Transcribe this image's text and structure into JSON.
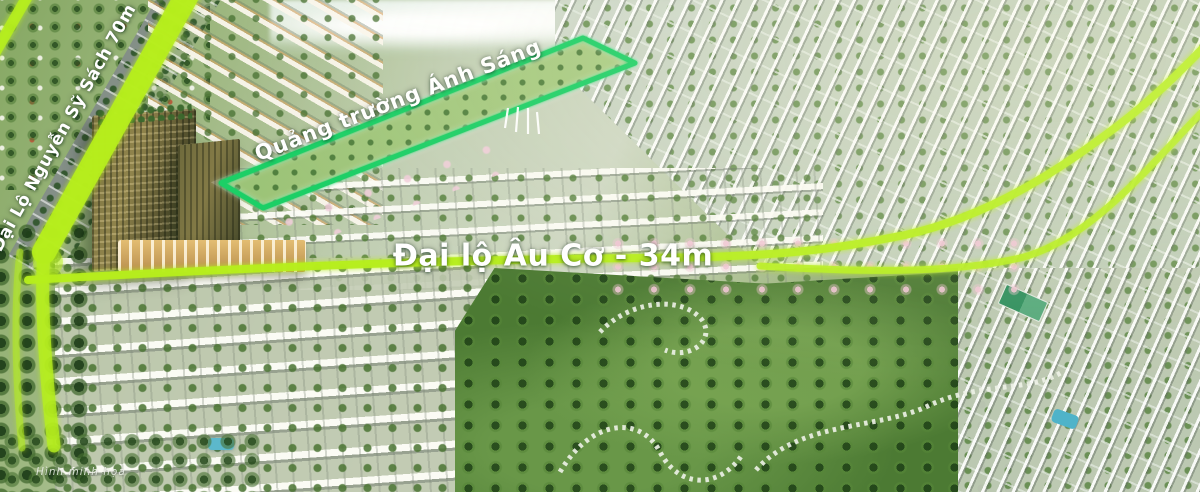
{
  "scene": {
    "description": "Aerial 3D masterplan render of an eco-urban township with highlighted avenues and central light square"
  },
  "colors": {
    "highway_highlight": "#b6ee1e",
    "plaza_outline": "#1dcf66",
    "label_text": "#ffffff",
    "watermark_text": "#eef3ea",
    "park_path": "#eef2e8",
    "fountain_white": "#ffffff"
  },
  "labels": {
    "road_diagonal": "Đại Lộ Nguyễn Sỹ Sách 70m",
    "plaza": "Quảng trường Ánh Sáng",
    "road_main": "Đại lộ Âu Cơ - 34m",
    "watermark": "Hình minh họa"
  }
}
